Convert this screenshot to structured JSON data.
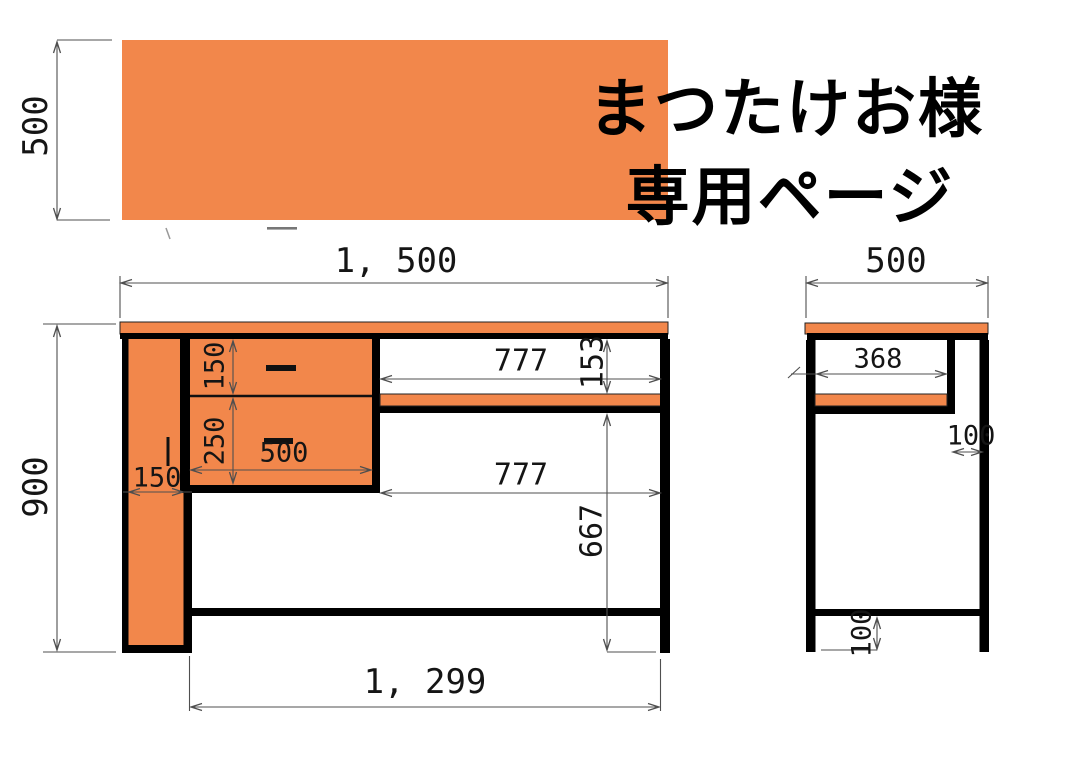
{
  "title": {
    "line1": "まつたけお様",
    "line2": "専用ページ"
  },
  "labels": {
    "top_panel_height": "500",
    "front_width": "1, 500",
    "front_height": "900",
    "front_leg_width": "150",
    "drawer_upper_height": "150",
    "drawer_lower_height": "250",
    "drawer_width": "500",
    "upper_opening_width": "777",
    "upper_opening_height": "153",
    "lower_opening_width": "777",
    "lower_opening_height": "667",
    "front_bottom_inner_width": "1, 299",
    "side_depth": "500",
    "side_shelf_depth": "368",
    "side_back_gap": "100",
    "side_rail_floor_gap": "100"
  },
  "colors": {
    "panel_orange": "#F2874B",
    "structure_black": "#000000",
    "dimension_gray": "#4f4f4f",
    "background": "#FFFFFF"
  }
}
